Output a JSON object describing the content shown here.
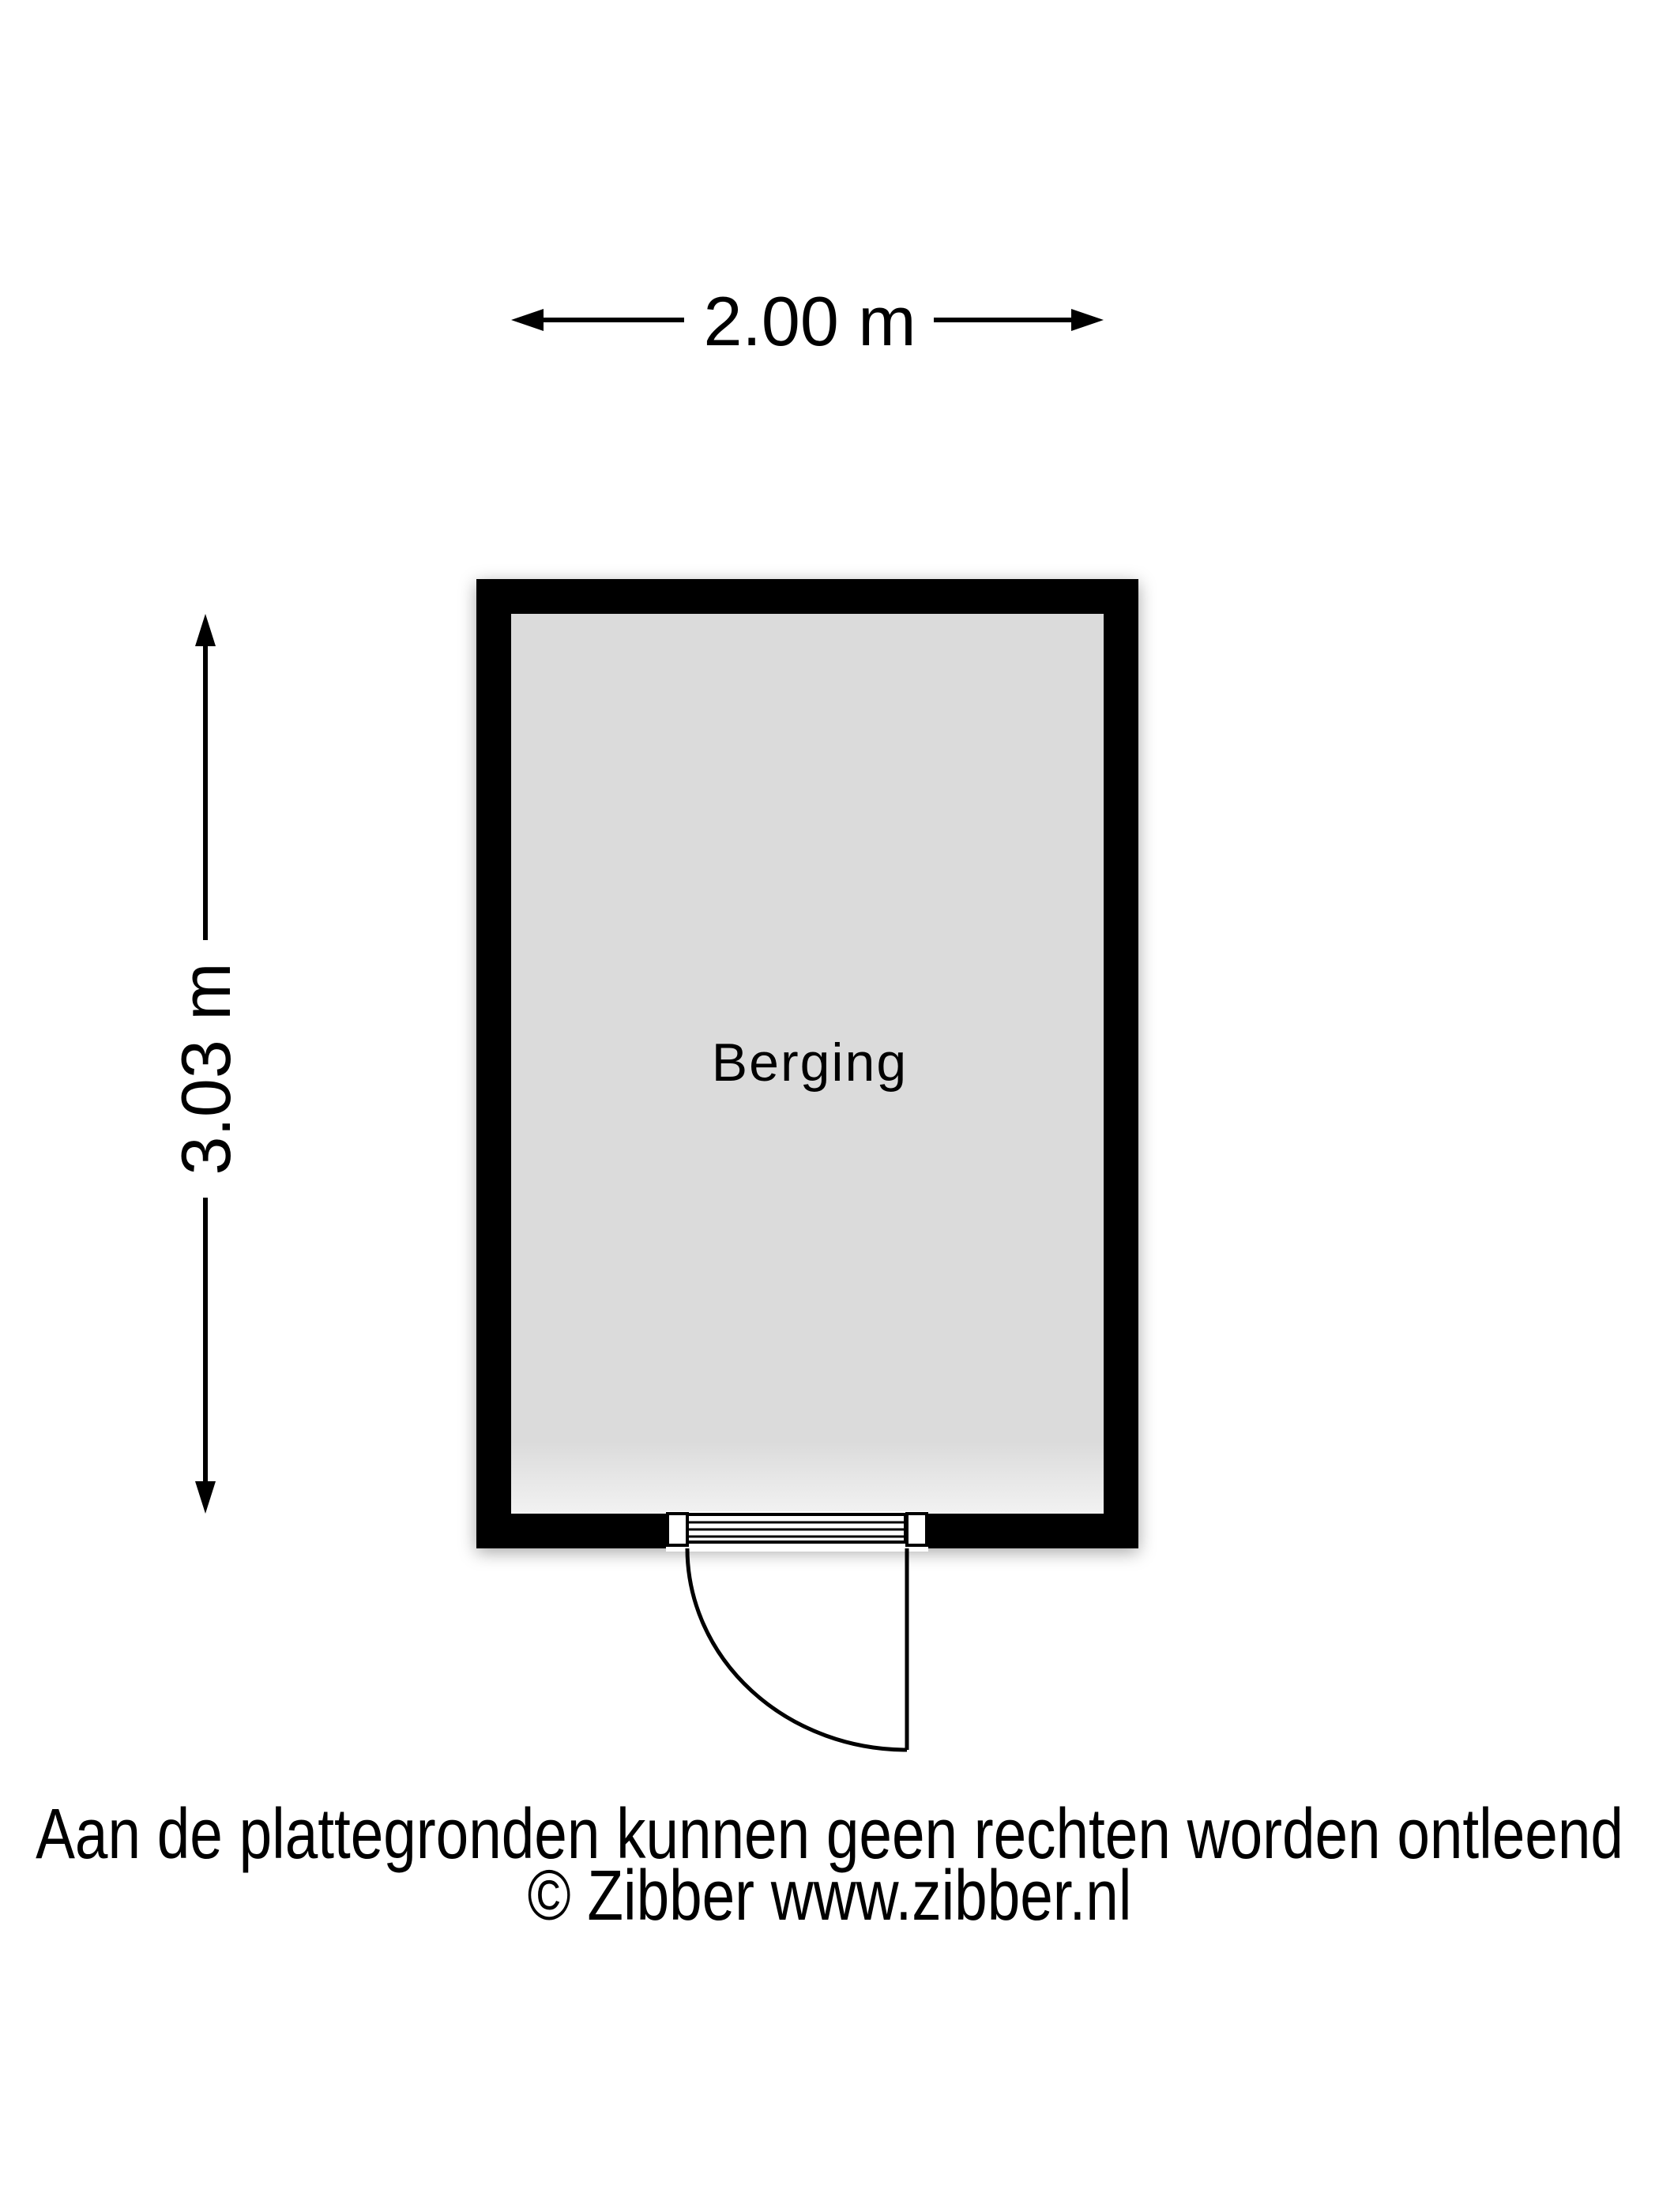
{
  "floorplan": {
    "room": {
      "label": "Berging",
      "floor_color": "#dbdbdb",
      "wall_color": "#000000"
    },
    "dimensions": {
      "width_label": "2.00 m",
      "height_label": "3.03 m"
    }
  },
  "footer": {
    "disclaimer": "Aan de plattegronden kunnen geen rechten worden ontleend",
    "copyright": "© Zibber www.zibber.nl"
  },
  "colors": {
    "background": "#ffffff",
    "line": "#000000",
    "text": "#000000"
  }
}
